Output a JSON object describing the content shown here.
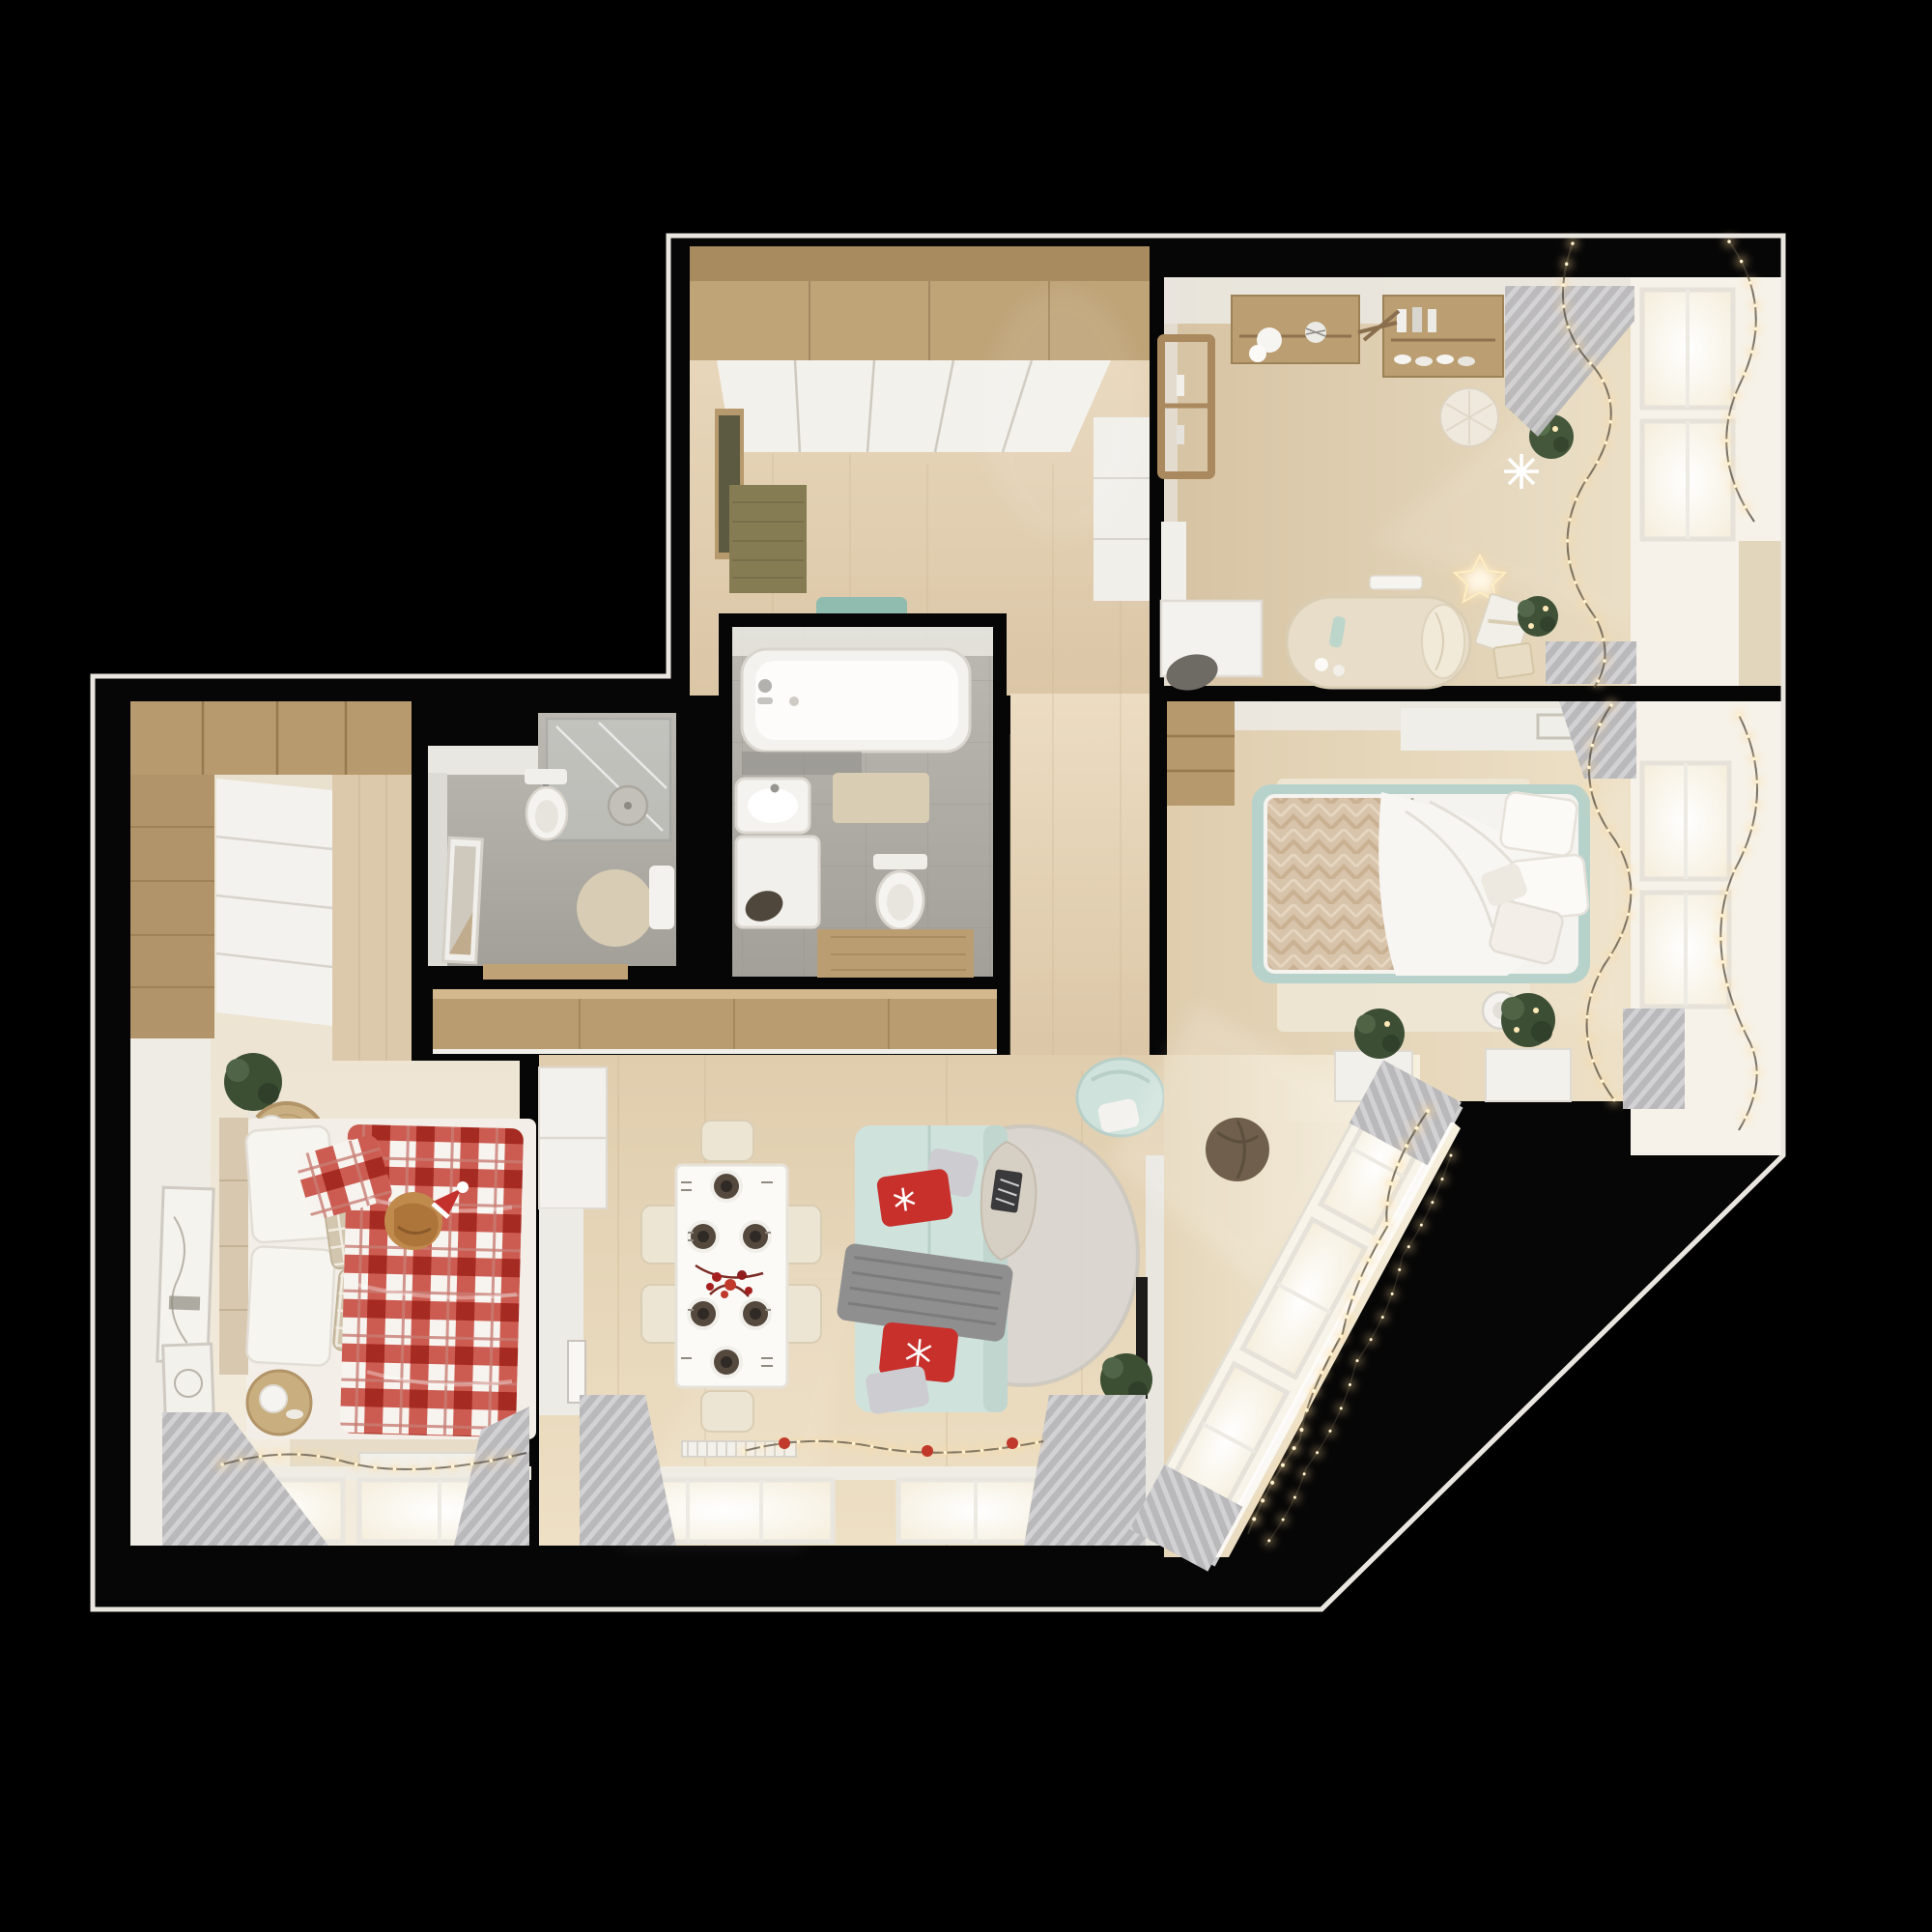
{
  "meta": {
    "description": "Top-down 3D render of a furnished one-bedroom-plus apartment floor plan with Christmas decor",
    "view": "top-down orthographic render",
    "visible_text": "none"
  },
  "palette": {
    "background": "#000000",
    "outline": "#e9e6e0",
    "floor_wood": "#ddc9a9",
    "floor_cream": "#ece4d4",
    "tile_gray": "#aba89f",
    "furniture_wood": "#bb9e72",
    "furniture_white": "#f3f1ec",
    "sofa_mint": "#cfe2dc",
    "bed_mint": "#b7d2cb",
    "bench_teal": "#8fbcae",
    "mat_olive": "#867c54",
    "pillow_red": "#c8302c",
    "plaid_red": "#c23a2e",
    "throw_gray": "#8f8f8f",
    "curtain_gray": "#b9b8ba",
    "garland_glow": "#ffd998",
    "plant_green": "#3f5137",
    "window_light": "#fffdf6",
    "tv_black": "#1d1c1a",
    "pouf_brown": "#6f5f4c"
  },
  "rooms": [
    {
      "id": "entry-hall",
      "furniture": [
        "wardrobe-top",
        "wardrobe-doors",
        "entry-cabinet",
        "door-mat",
        "teal-bench",
        "hall-cabinets"
      ]
    },
    {
      "id": "kids-room",
      "furniture": [
        "wall-shelf-left",
        "wall-shelf-right",
        "clothes-rack",
        "desk",
        "desk-chair",
        "desk-cabinet",
        "daybed",
        "bolster",
        "knit-pouf",
        "star-light",
        "gift-boxes",
        "plant-pots",
        "snowflake-decor",
        "windows",
        "garland",
        "curtains"
      ]
    },
    {
      "id": "bathroom",
      "furniture": [
        "bathtub",
        "glass-screen",
        "sink",
        "washing-machine",
        "toilet",
        "bath-mat",
        "wood-threshold"
      ]
    },
    {
      "id": "shower-room",
      "furniture": [
        "shower-enclosure",
        "toilet",
        "leaning-mirror",
        "round-rug",
        "sink"
      ]
    },
    {
      "id": "bedroom-left",
      "furniture": [
        "wardrobe",
        "sliding-doors",
        "plaid-bed",
        "pillows",
        "cat-with-santa-hat",
        "rattan-side-table",
        "table-lamp",
        "plant",
        "leaning-frames",
        "rug",
        "foot-bench",
        "round-table",
        "windows",
        "garland",
        "curtains"
      ]
    },
    {
      "id": "living-dining",
      "furniture": [
        "kitchen-cabinets",
        "wall-art",
        "wood-console",
        "dining-table",
        "plates",
        "chairs",
        "sofa",
        "red-pillows",
        "silver-pillows",
        "gray-throw",
        "round-rug",
        "coffee-table",
        "magazine",
        "mint-armchair",
        "tv",
        "shelf-unit",
        "plant",
        "windows",
        "garland-red-baubles",
        "curtains",
        "radiator"
      ]
    },
    {
      "id": "bedroom-right",
      "furniture": [
        "mint-bed",
        "white-duvet",
        "herringbone-throw",
        "pillows",
        "rug",
        "wardrobe",
        "headboard-shelf",
        "dresser",
        "planter",
        "plant",
        "air-purifier",
        "windows",
        "garland",
        "curtains"
      ]
    },
    {
      "id": "balcony-corridor",
      "furniture": [
        "diagonal-window-wall",
        "garland",
        "curtains",
        "console",
        "plant",
        "pouf"
      ]
    }
  ]
}
